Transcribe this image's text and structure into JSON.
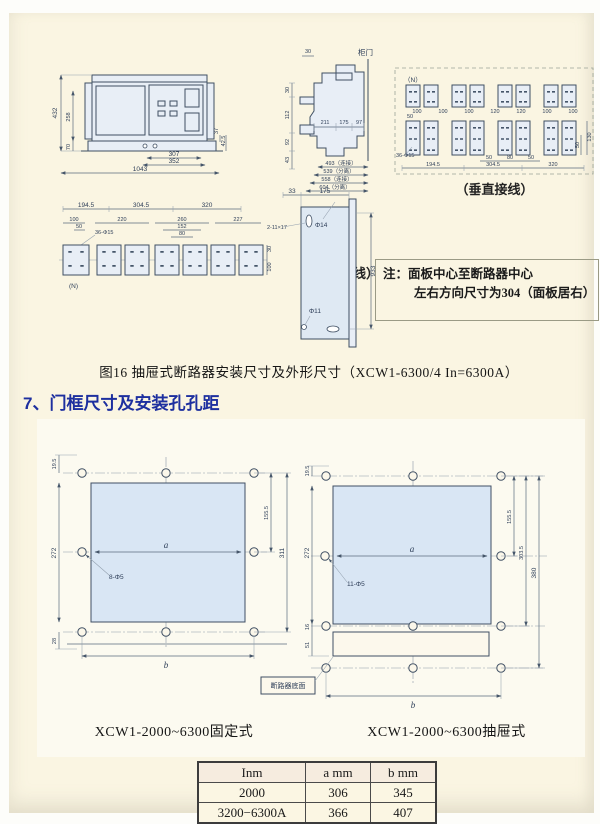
{
  "colors": {
    "heading_blue": "#1d2f9f",
    "window_fill": "#d9e6f4",
    "paper": "#faf5e2"
  },
  "figure16": {
    "caption": "图16 抽屉式断路器安装尺寸及外形尺寸（XCW1-6300/4 In=6300A）",
    "front_view": {
      "d432": "432",
      "d258": "258",
      "d70": "70",
      "d307": "307",
      "d352": "352",
      "d1043": "1043",
      "d37": "37",
      "d42_5": "42.5"
    },
    "side_view": {
      "door": "柜门",
      "d30_top": "30",
      "d30": "30",
      "d112": "112",
      "d92": "92",
      "d43": "43",
      "d211": "211",
      "d175": "175",
      "d97": "97",
      "d493": "493（连接）",
      "d539": "539（分离）",
      "d558": "558（连接）",
      "d604": "604（分离）"
    },
    "vertical_wiring": {
      "caption": "（垂直接线）",
      "n": "（N）",
      "holes": "36-Φ15",
      "d50": "50",
      "top_dims": [
        "100",
        "100",
        "100",
        "120",
        "120",
        "100",
        "100"
      ],
      "bottom_dims": [
        "50",
        "80",
        "50"
      ],
      "span_dims": [
        "194.5",
        "304.5",
        "320"
      ],
      "right_dims": [
        "130",
        "50"
      ]
    },
    "horizontal_wiring": {
      "caption": "（水平接线）",
      "n": "(N)",
      "holes": "36-Φ15",
      "span_dims": [
        "194.5",
        "304.5",
        "320"
      ],
      "d100": "100",
      "d50": "50",
      "d220": "220",
      "d260": "260",
      "d152": "152",
      "d80": "80",
      "d227": "227",
      "right_dims": [
        "30",
        "100"
      ]
    },
    "panel_view": {
      "d33": "33",
      "d175": "175",
      "d933": "933",
      "slot": "2-11×17",
      "hole_top": "Φ14",
      "hole_bottom": "Φ11"
    },
    "note_line1": "注：面板中心至断路器中心",
    "note_line2": "左右方向尺寸为304（面板居右）"
  },
  "section7": {
    "heading": "7、门框尺寸及安装孔孔距",
    "fixed_view": {
      "caption": "XCW1-2000~6300固定式",
      "d19_5": "19.5",
      "d272": "272",
      "d28": "28",
      "a": "a",
      "holes": "8-Φ5",
      "d155_5": "155.5",
      "d311": "311",
      "b": "b"
    },
    "drawout_view": {
      "caption": "XCW1-2000~6300抽屉式",
      "d19_5": "19.5",
      "d272": "272",
      "d16": "16",
      "d51": "51",
      "a": "a",
      "holes": "11-Φ5",
      "d155_5": "155.5",
      "d303_5": "303.5",
      "d380": "380",
      "b": "b",
      "bottom_label": "断路器底面"
    },
    "table": {
      "headers": [
        "Inm",
        "a mm",
        "b mm"
      ],
      "rows": [
        [
          "2000",
          "306",
          "345"
        ],
        [
          "3200−6300A",
          "366",
          "407"
        ]
      ]
    }
  }
}
